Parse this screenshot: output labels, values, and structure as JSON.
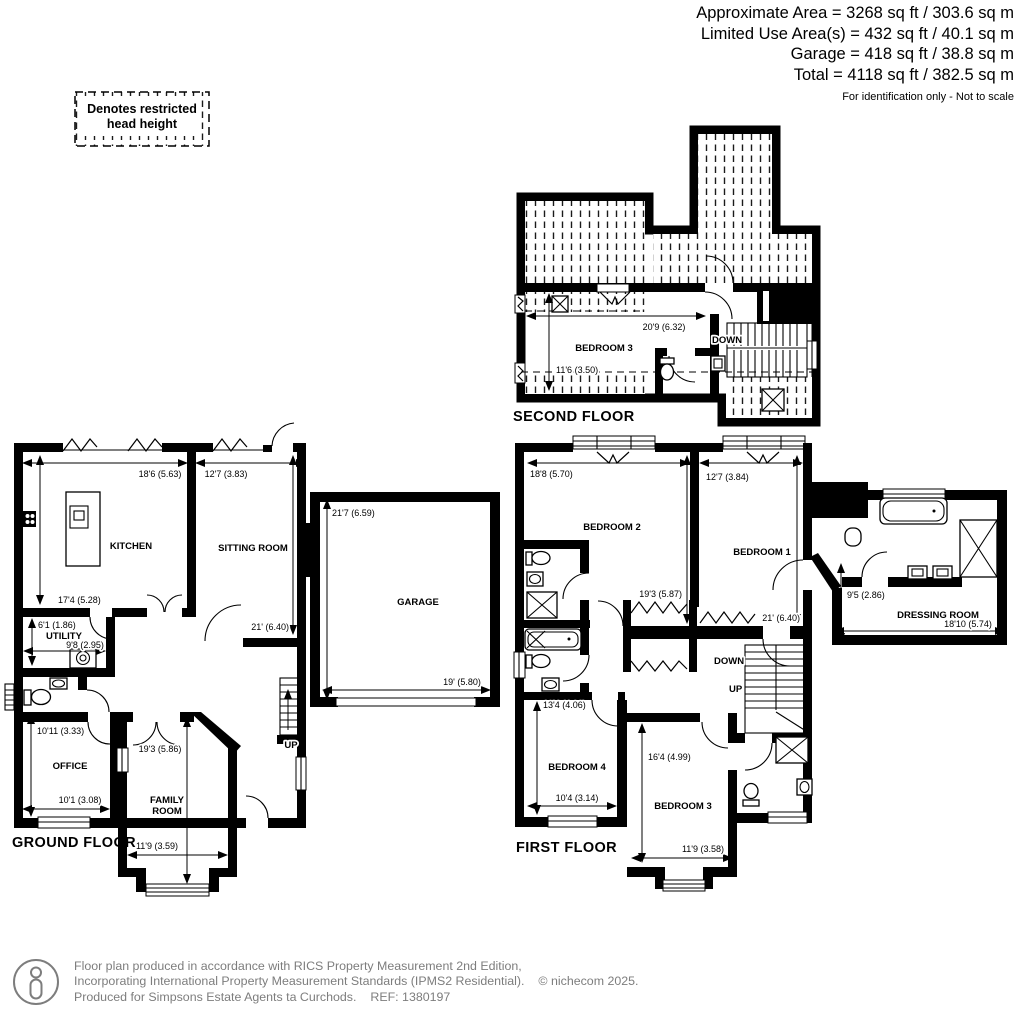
{
  "header": {
    "line1": "Approximate Area = 3268 sq ft / 303.6 sq m",
    "line2": "Limited Use Area(s) = 432 sq ft / 40.1 sq m",
    "line3": "Garage = 418 sq ft / 38.8 sq m",
    "line4": "Total = 4118 sq ft / 382.5 sq m",
    "note": "For identification only - Not to scale"
  },
  "legend": {
    "line1": "Denotes restricted",
    "line2": "head height"
  },
  "second_floor": {
    "title": "SECOND FLOOR",
    "bedroom3": {
      "name": "BEDROOM 3",
      "width": "20'9 (6.32)",
      "depth": "11'6 (3.50)"
    },
    "stairs_down": "DOWN"
  },
  "ground_floor": {
    "title": "GROUND FLOOR",
    "kitchen": {
      "name": "KITCHEN",
      "width": "18'6 (5.63)",
      "depth": "17'4 (5.28)"
    },
    "sitting_room": {
      "name": "SITTING ROOM",
      "width": "12'7 (3.83)",
      "depth": "21' (6.40)"
    },
    "utility": {
      "name": "UTILITY",
      "depth": "6'1 (1.86)",
      "width": "9'8 (2.95)"
    },
    "office": {
      "name": "OFFICE",
      "depth": "10'11 (3.33)",
      "width": "10'1 (3.08)"
    },
    "family_room": {
      "name_line1": "FAMILY",
      "name_line2": "ROOM",
      "depth": "19'3 (5.86)",
      "width": "11'9 (3.59)"
    },
    "garage": {
      "name": "GARAGE",
      "depth": "21'7 (6.59)",
      "width": "19' (5.80)"
    },
    "stairs_up": "UP"
  },
  "first_floor": {
    "title": "FIRST FLOOR",
    "bedroom1": {
      "name": "BEDROOM 1",
      "width": "12'7 (3.84)",
      "depth": "21' (6.40)"
    },
    "bedroom2": {
      "name": "BEDROOM 2",
      "width": "18'8 (5.70)",
      "depth": "19'3 (5.87)"
    },
    "bedroom3": {
      "name": "BEDROOM 3",
      "depth": "16'4 (4.99)",
      "width": "11'9 (3.58)"
    },
    "bedroom4": {
      "name": "BEDROOM 4",
      "depth": "13'4 (4.06)",
      "width": "10'4 (3.14)"
    },
    "dressing_room": {
      "name": "DRESSING ROOM",
      "depth": "9'5 (2.86)",
      "width": "18'10 (5.74)"
    },
    "stairs_down": "DOWN",
    "stairs_up": "UP"
  },
  "footer": {
    "line1": "Floor plan produced in accordance with RICS Property Measurement 2nd Edition,",
    "line2": "Incorporating International Property Measurement Standards (IPMS2 Residential).",
    "copyright": "© nichecom 2025.",
    "line3": "Produced for Simpsons Estate Agents ta Curchods.",
    "ref": "REF: 1380197"
  }
}
